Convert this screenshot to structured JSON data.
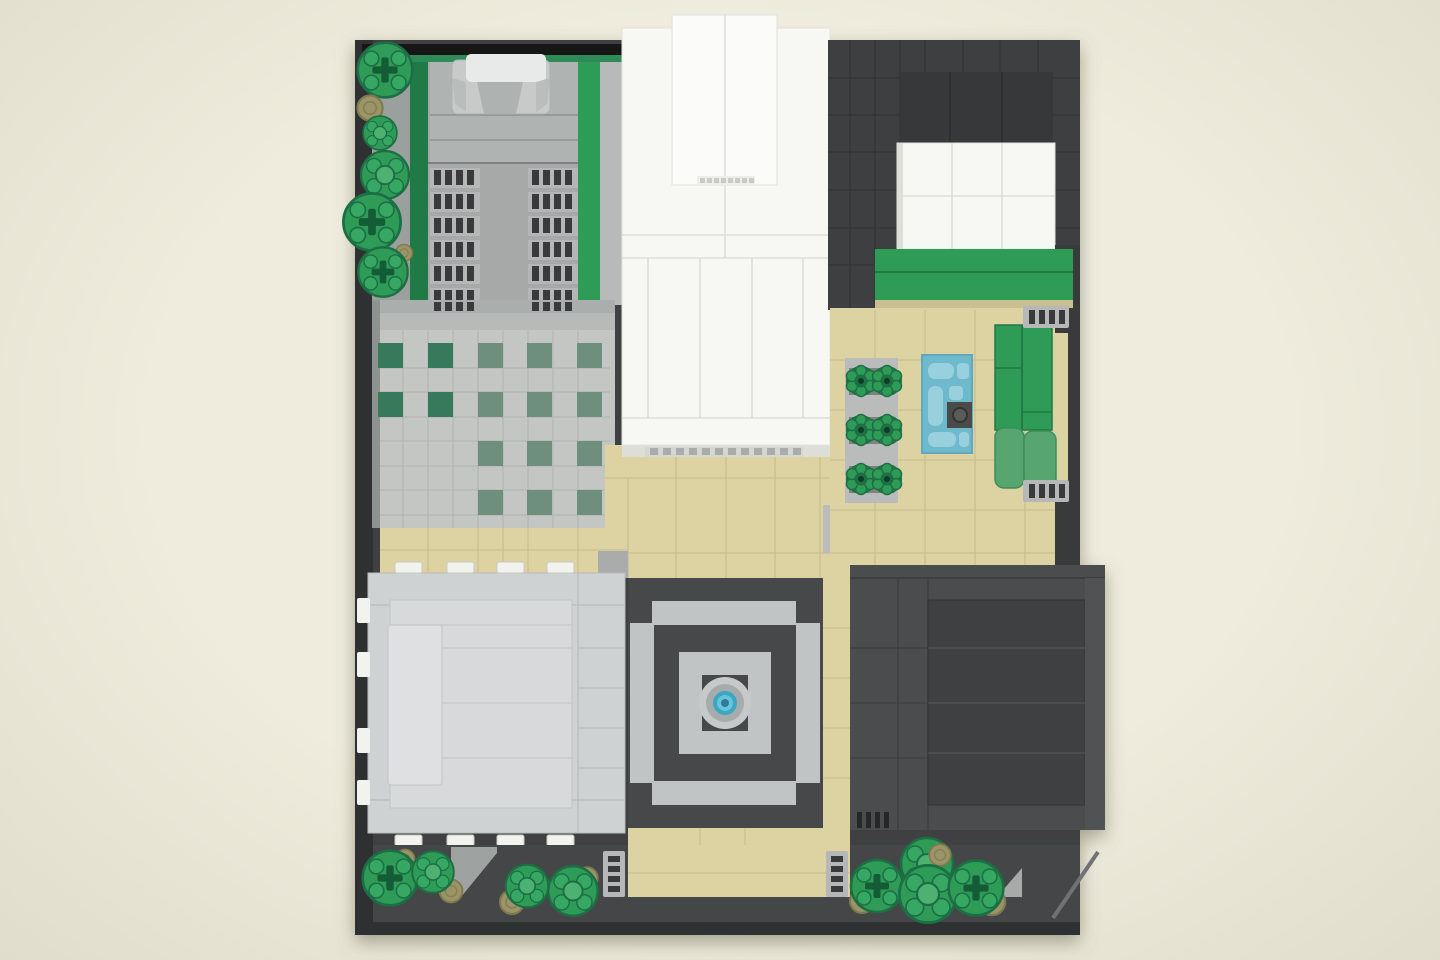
{
  "meta": {
    "kind": "rendered-lego-model-top-view",
    "canvas": {
      "width": 1440,
      "height": 960
    }
  },
  "colors": {
    "bg": "#EFECDD",
    "bgEdge": "#E0DDCC",
    "plate": "#404143",
    "plateEdge": "#2F3032",
    "black": "#161616",
    "road": "#454648",
    "grass": "#2E8B57",
    "green": "#2E9B57",
    "greenDark": "#1F7A46",
    "sage": "#6F8F7D",
    "sageDark": "#37795B",
    "tree": "#2E9B57",
    "olive": "#9B9467",
    "facade": "#A6A9A7",
    "facadeLight": "#B7BAB8",
    "plaza": "#C3C6C2",
    "roofLight": "#CFD2D3",
    "white": "#F7F7F4",
    "whiteBright": "#FBFBF9",
    "tan": "#DCD2A2",
    "tanSeam": "#C9BE8F",
    "blue": "#6FB9CD",
    "blueLight": "#98D0DD",
    "teal": "#3DA6C2",
    "grille": "#B5B8B6",
    "slot": "#3A3A3C",
    "courtLight": "#C1C4C5",
    "courtDark": "#474849",
    "bldgDark": "#4B4C4E",
    "bldgDarker": "#3F4042",
    "darkroof": "#3E3F41",
    "roofBlock": "#37383A",
    "studWhite": "#F2F2EF",
    "grayTile": "#A9ACAA"
  },
  "scene": {
    "baseplate": {
      "color_key": "plate"
    },
    "regions": [
      {
        "name": "garden-with-car-building",
        "position": "top-left",
        "color_key": "grass"
      },
      {
        "name": "white-tower-building",
        "position": "top-center",
        "color_key": "white"
      },
      {
        "name": "dark-roof-white-annex",
        "position": "top-right",
        "color_key": "darkroof"
      },
      {
        "name": "cafe-terrace",
        "position": "middle-right",
        "color_key": "tan",
        "furniture": [
          "green-table-sets",
          "blue-pool-table",
          "green-sofa",
          "vent-grilles"
        ]
      },
      {
        "name": "plaza-with-planters",
        "position": "middle-left",
        "color_key": "plaza"
      },
      {
        "name": "light-gray-building",
        "position": "bottom-left",
        "color_key": "roofLight"
      },
      {
        "name": "courtyard-with-fountain",
        "position": "bottom-center",
        "color_key": "courtDark"
      },
      {
        "name": "dark-gray-building",
        "position": "bottom-right",
        "color_key": "bldgDark"
      },
      {
        "name": "street-with-trees",
        "position": "bottom-edge",
        "color_key": "road"
      }
    ],
    "tree_count": 13,
    "fountain": {
      "shape": "round",
      "water_color_key": "teal"
    }
  }
}
